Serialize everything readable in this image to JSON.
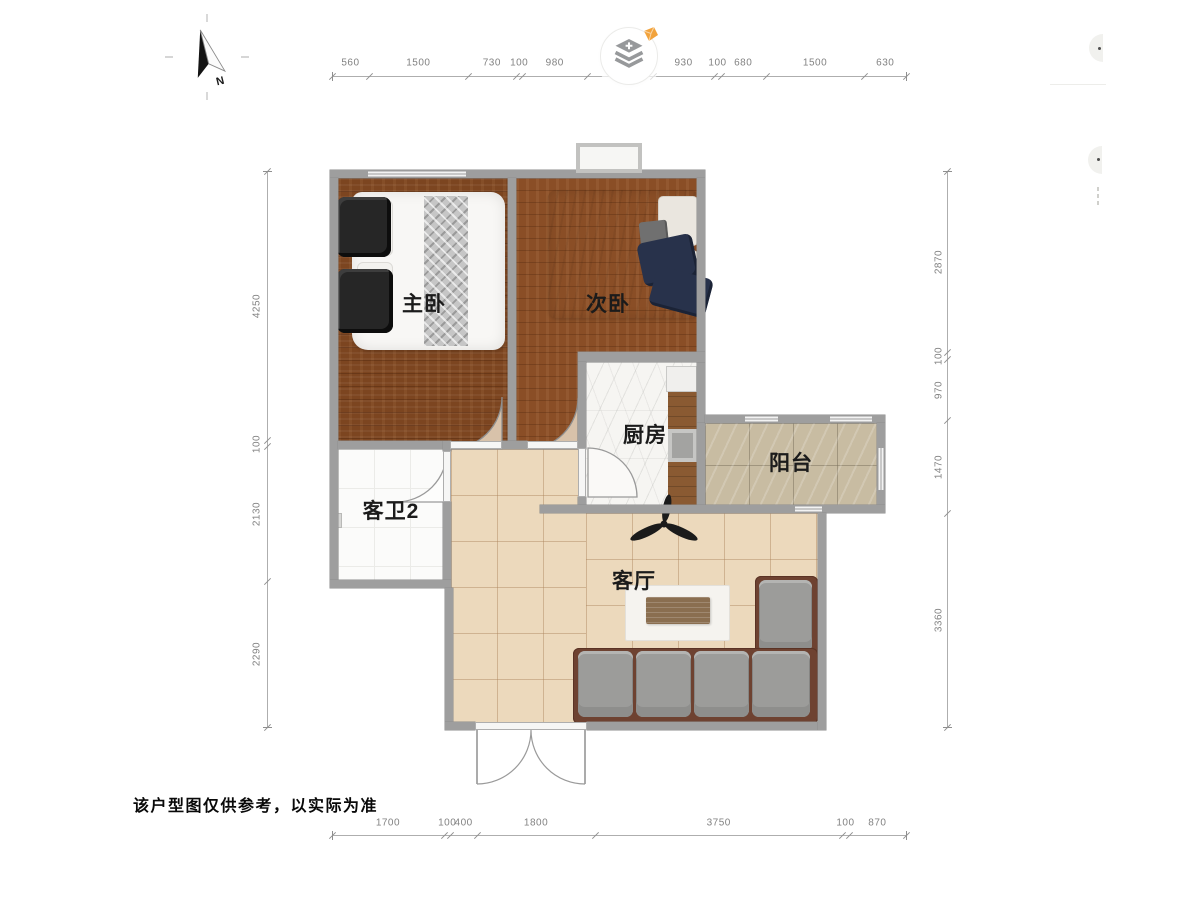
{
  "disclaimer": "该户型图仅供参考，以实际为准",
  "compass": {
    "north_label": "N"
  },
  "rooms": [
    {
      "id": "master-bedroom",
      "label": "主卧"
    },
    {
      "id": "second-bedroom",
      "label": "次卧"
    },
    {
      "id": "kitchen",
      "label": "厨房"
    },
    {
      "id": "balcony",
      "label": "阳台"
    },
    {
      "id": "guest-bathroom",
      "label": "客卫2"
    },
    {
      "id": "living-room",
      "label": "客厅"
    }
  ],
  "dimensions_mm": {
    "top": [
      560,
      1500,
      730,
      100,
      980,
      1000,
      930,
      100,
      680,
      1500,
      630
    ],
    "bottom": [
      1700,
      100,
      400,
      1800,
      3750,
      100,
      870
    ],
    "left": [
      4250,
      100,
      2130,
      2290
    ],
    "right": [
      2870,
      100,
      970,
      1470,
      3360
    ]
  },
  "icons": {
    "logo": "stacked-layers-icon",
    "logo_gem": "diamond-gem-icon",
    "compass": "north-arrow-icon",
    "fan": "ceiling-fan-icon"
  },
  "palette": {
    "wall": "#9e9e9e",
    "wood_master": "#7c4520",
    "wood_second": "#8a4e26",
    "tile_living": "#ecd9bc",
    "tile_balcony": "#c8bca2",
    "marble_kitchen": "#f6f5f2",
    "bath_floor": "#fbfbfa",
    "door_arc": "#d8c2aa",
    "sofa": "#9c9c9a",
    "sofa_frame": "#6e4231",
    "gem_orange": "#f2a33c",
    "logo_gray": "#97999b"
  }
}
